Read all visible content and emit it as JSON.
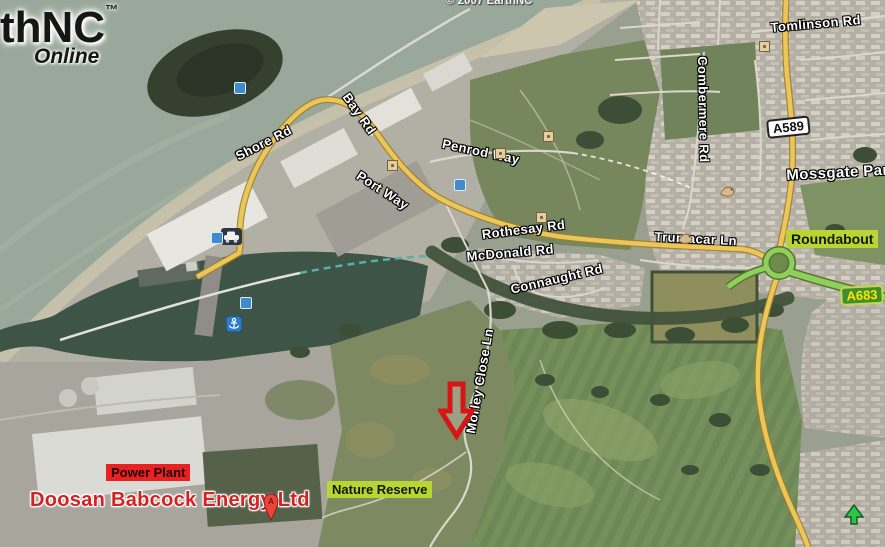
{
  "app": {
    "logo_line1": "thNC",
    "logo_tm": "™",
    "logo_line2": "Online",
    "copyright": "© 2007 EarthNC"
  },
  "road_labels": [
    "Shore Rd",
    "Bay Rd",
    "Port Way",
    "Penrod Way",
    "Rothesay Rd",
    "McDonald Rd",
    "Connaught Rd",
    "Trumacar Ln",
    "Combermere Rd",
    "Tomlinson Rd",
    "Mossgate Park",
    "Morley Close Ln"
  ],
  "badges": {
    "a589": "A589",
    "a683": "A683"
  },
  "highlight_labels": {
    "roundabout": "Roundabout",
    "nature_reserve": "Nature Reserve",
    "power_plant": "Power Plant"
  },
  "poi": {
    "company_label": "Doosan Babcock Energy Ltd",
    "pin_letter": "A"
  },
  "icons": {
    "pin": "map-pin",
    "red_arrow": "location-arrow",
    "car": "car-placemark",
    "anchor": "harbor-anchor",
    "bird": "bird-placemark",
    "green_arrow": "park-arrow",
    "blue_square": "info-placemark",
    "waypoint": "waypoint-square"
  },
  "colors": {
    "road_primary": "#ecc758",
    "road_a683": "#8ecf5e",
    "sea": "#99a89a",
    "harbor_water": "#3e5446",
    "highlight_bg": "#b8d435",
    "power_plant_bg": "#e82222",
    "company_text": "#d42222",
    "a683_bg": "#3f8f2e",
    "a683_text": "#ffe400",
    "arrow_red": "#d61616"
  }
}
